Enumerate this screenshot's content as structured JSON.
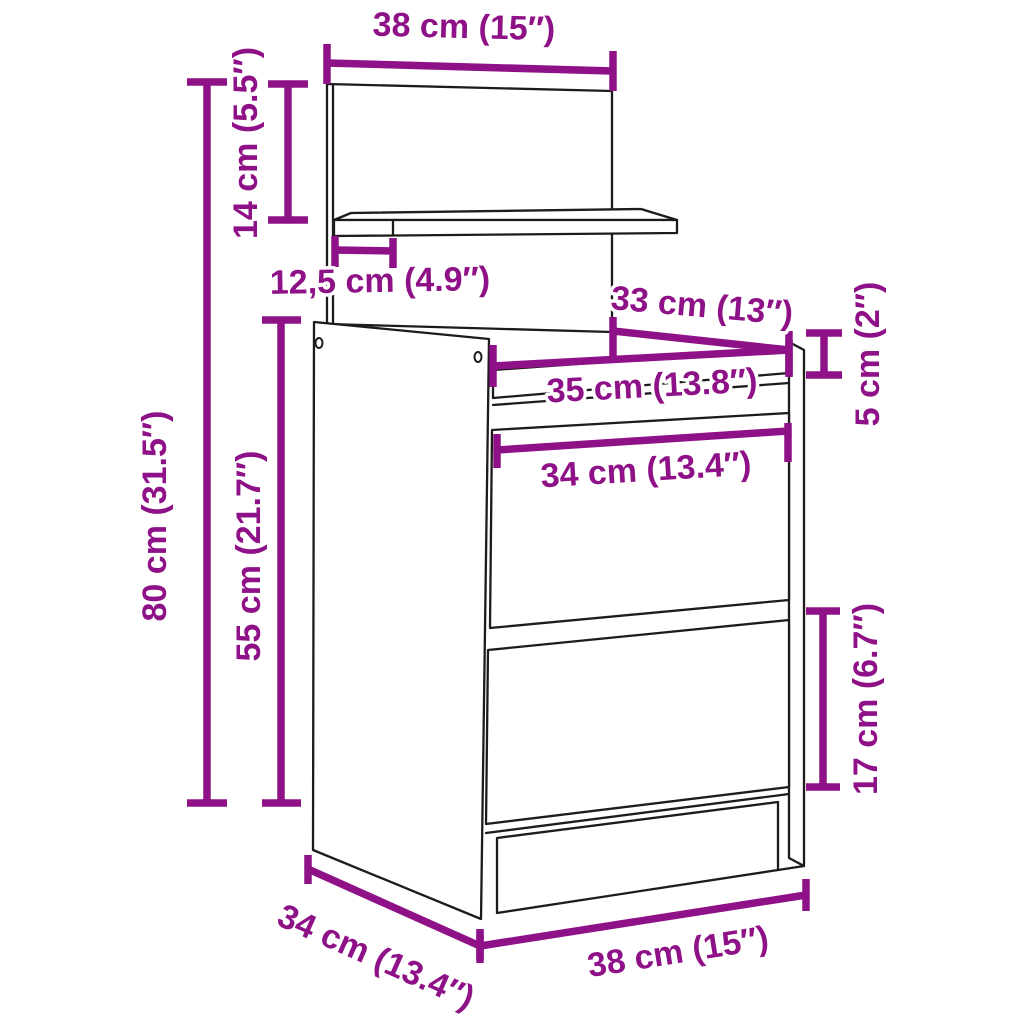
{
  "colors": {
    "accent": "#8F1187",
    "line": "#1c1c1c",
    "bg": "#ffffff"
  },
  "diagram": {
    "dimensions": {
      "back_panel_width": "38 cm (15″)",
      "back_panel_height": "14 cm (5.5″)",
      "shelf_depth": "12,5 cm (4.9″)",
      "overall_height": "80 cm (31.5″)",
      "cabinet_height": "55 cm (21.7″)",
      "top_clear_width": "33 cm (13″)",
      "rail_width": "35 cm (13.8″)",
      "drawer_width": "34 cm (13.4″)",
      "rail_height": "5 cm (2″)",
      "lower_drawer_height": "17 cm (6.7″)",
      "depth": "34 cm (13.4″)",
      "overall_width": "38 cm (15″)"
    }
  }
}
